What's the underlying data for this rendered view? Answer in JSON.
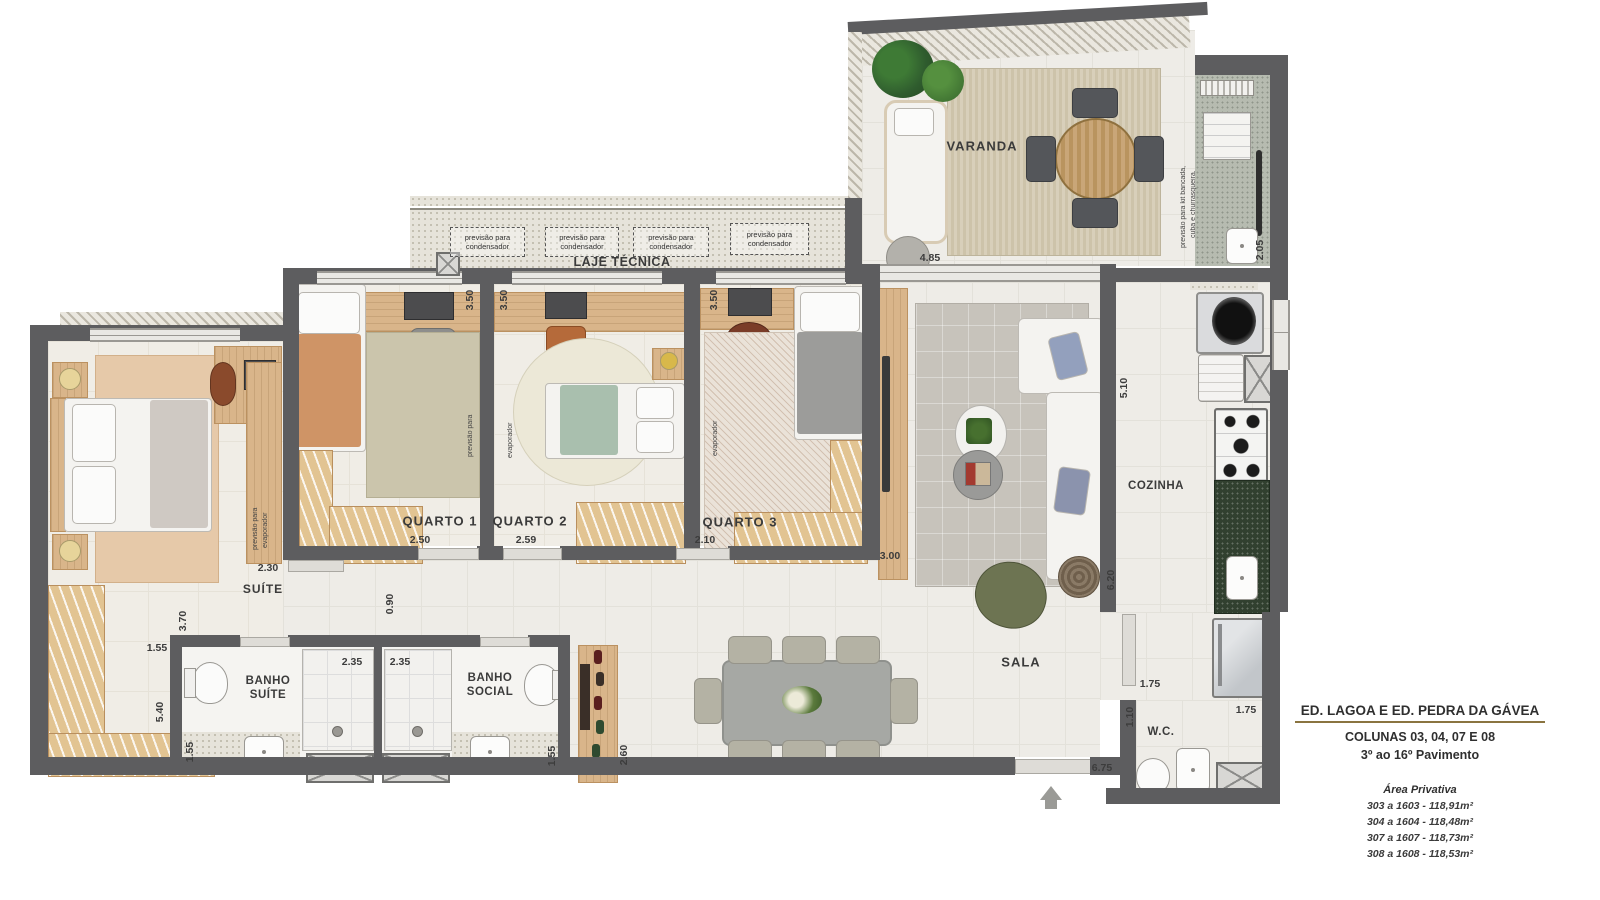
{
  "rooms": {
    "varanda": "VARANDA",
    "suite": "SUÍTE",
    "quarto1": "QUARTO 1",
    "quarto2": "QUARTO 2",
    "quarto3": "QUARTO 3",
    "banho_suite_1": "BANHO",
    "banho_suite_2": "SUÍTE",
    "banho_social_1": "BANHO",
    "banho_social_2": "SOCIAL",
    "sala": "SALA",
    "cozinha": "COZINHA",
    "wc": "W.C.",
    "laje": "LAJE TÉCNICA"
  },
  "annotations": {
    "condensador": "previsão para condensador",
    "previsao_para": "previsão para",
    "evaporador": "evaporador",
    "kit_line1": "previsão para kit bancada,",
    "kit_line2": "cuba e churrasqueira."
  },
  "dims": {
    "q1_depth": "3.50",
    "q2_depth": "3.50",
    "q3_depth": "3.50",
    "q1_door": "2.50",
    "q2_door": "2.59",
    "q3_door": "2.10",
    "sala_wall": "3.00",
    "suite_closet": "2.30",
    "suite_hall": "3.70",
    "hall_w": "1.55",
    "suite_len": "5.40",
    "closet_w": "1.55",
    "shower_suite": "2.35",
    "shower_social": "2.35",
    "hall_narrow": "0.90",
    "social_w": "1.55",
    "adega": "2.60",
    "varanda_w": "4.85",
    "churras_h": "2.05",
    "cozinha_len": "5.10",
    "sala_len": "6.20",
    "wc_w1": "1.75",
    "wc_h": "1.10",
    "wc_w2": "1.75",
    "entry_w": "6.75"
  },
  "info_panel": {
    "title": "ED. LAGOA E ED. PEDRA DA GÁVEA",
    "line1": "COLUNAS 03, 04, 07 E 08",
    "line2": "3º ao 16º Pavimento",
    "area_heading": "Área Privativa",
    "areas": {
      "a1": "303 a 1603 - 118,91m²",
      "a2": "304 a 1604 - 118,48m²",
      "a3": "307 a 1607 - 118,73m²",
      "a4": "308 a 1608 - 118,53m²"
    }
  }
}
